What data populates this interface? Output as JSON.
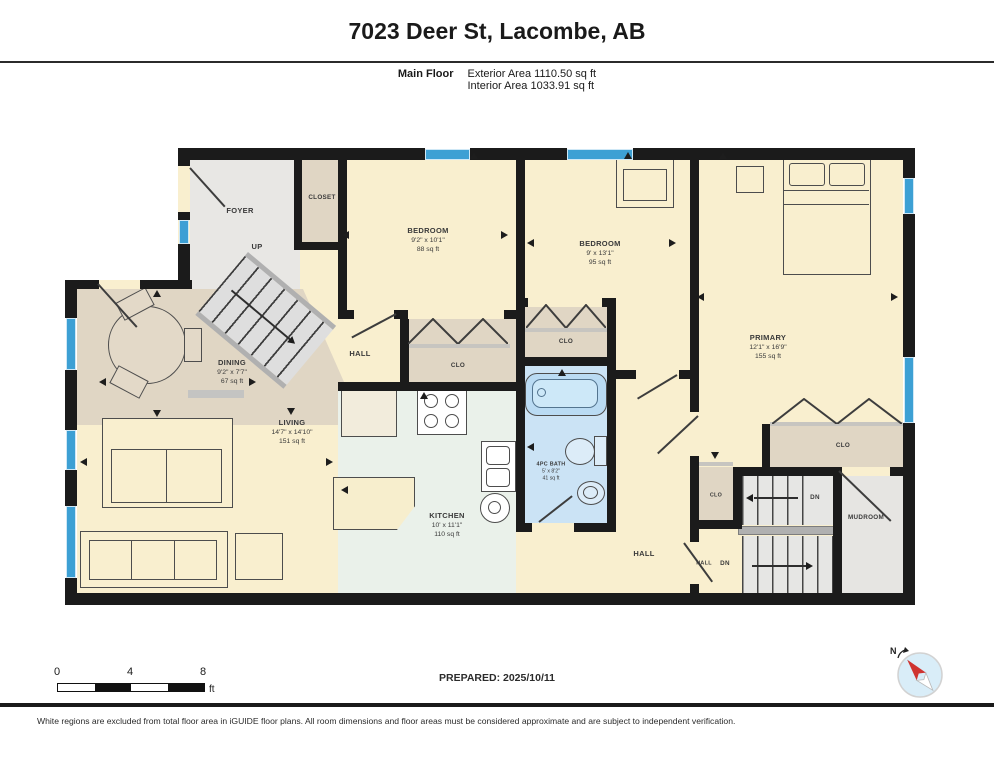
{
  "header": {
    "title": "7023 Deer St, Lacombe, AB",
    "floor_label": "Main Floor",
    "exterior_area": "Exterior Area 1110.50 sq ft",
    "interior_area": "Interior Area 1033.91 sq ft"
  },
  "rooms": {
    "foyer": {
      "name": "FOYER"
    },
    "closet": {
      "name": "CLOSET"
    },
    "bedroom1": {
      "name": "BEDROOM",
      "dims": "9'2\" x 10'1\"",
      "area": "88 sq ft"
    },
    "bedroom2": {
      "name": "BEDROOM",
      "dims": "9' x 13'1\"",
      "area": "95 sq ft"
    },
    "primary": {
      "name": "PRIMARY",
      "dims": "12'1\" x 16'9\"",
      "area": "155 sq ft"
    },
    "dining": {
      "name": "DINING",
      "dims": "9'2\" x 7'7\"",
      "area": "67 sq ft"
    },
    "living": {
      "name": "LIVING",
      "dims": "14'7\" x 14'10\"",
      "area": "151 sq ft"
    },
    "kitchen": {
      "name": "KITCHEN",
      "dims": "10' x 11'1\"",
      "area": "110 sq ft"
    },
    "bath": {
      "name": "4PC BATH",
      "dims": "5' x 8'2\"",
      "area": "41 sq ft"
    },
    "mudroom": {
      "name": "MUDROOM"
    }
  },
  "labels": {
    "up": "UP",
    "dn_upper": "DN",
    "dn_lower": "DN",
    "hall_center": "HALL",
    "hall_right": "HALL",
    "hall_stairs": "HALL",
    "clo_bedroom1": "CLO",
    "clo_bedroom2": "CLO",
    "clo_primary": "CLO",
    "clo_hall": "CLO"
  },
  "scale_bar": {
    "tick_0": "0",
    "tick_4": "4",
    "tick_8": "8",
    "unit": "ft"
  },
  "compass": {
    "north": "N"
  },
  "footer": {
    "prepared": "PREPARED: 2025/10/11",
    "disclaimer": "White regions are excluded from total floor area in iGUIDE floor plans. All room dimensions and floor areas must be considered approximate and are subject to independent verification."
  },
  "colors": {
    "wall": "#1b1b1b",
    "window_blue": "#3da0d4",
    "floor_cream": "#f9efcf",
    "floor_tan": "#e0d6c4",
    "floor_gray": "#e8e7e4",
    "floor_mint": "#eaf1ea",
    "floor_bath_blue": "#cbe3f5",
    "compass_red": "#cf3430"
  }
}
